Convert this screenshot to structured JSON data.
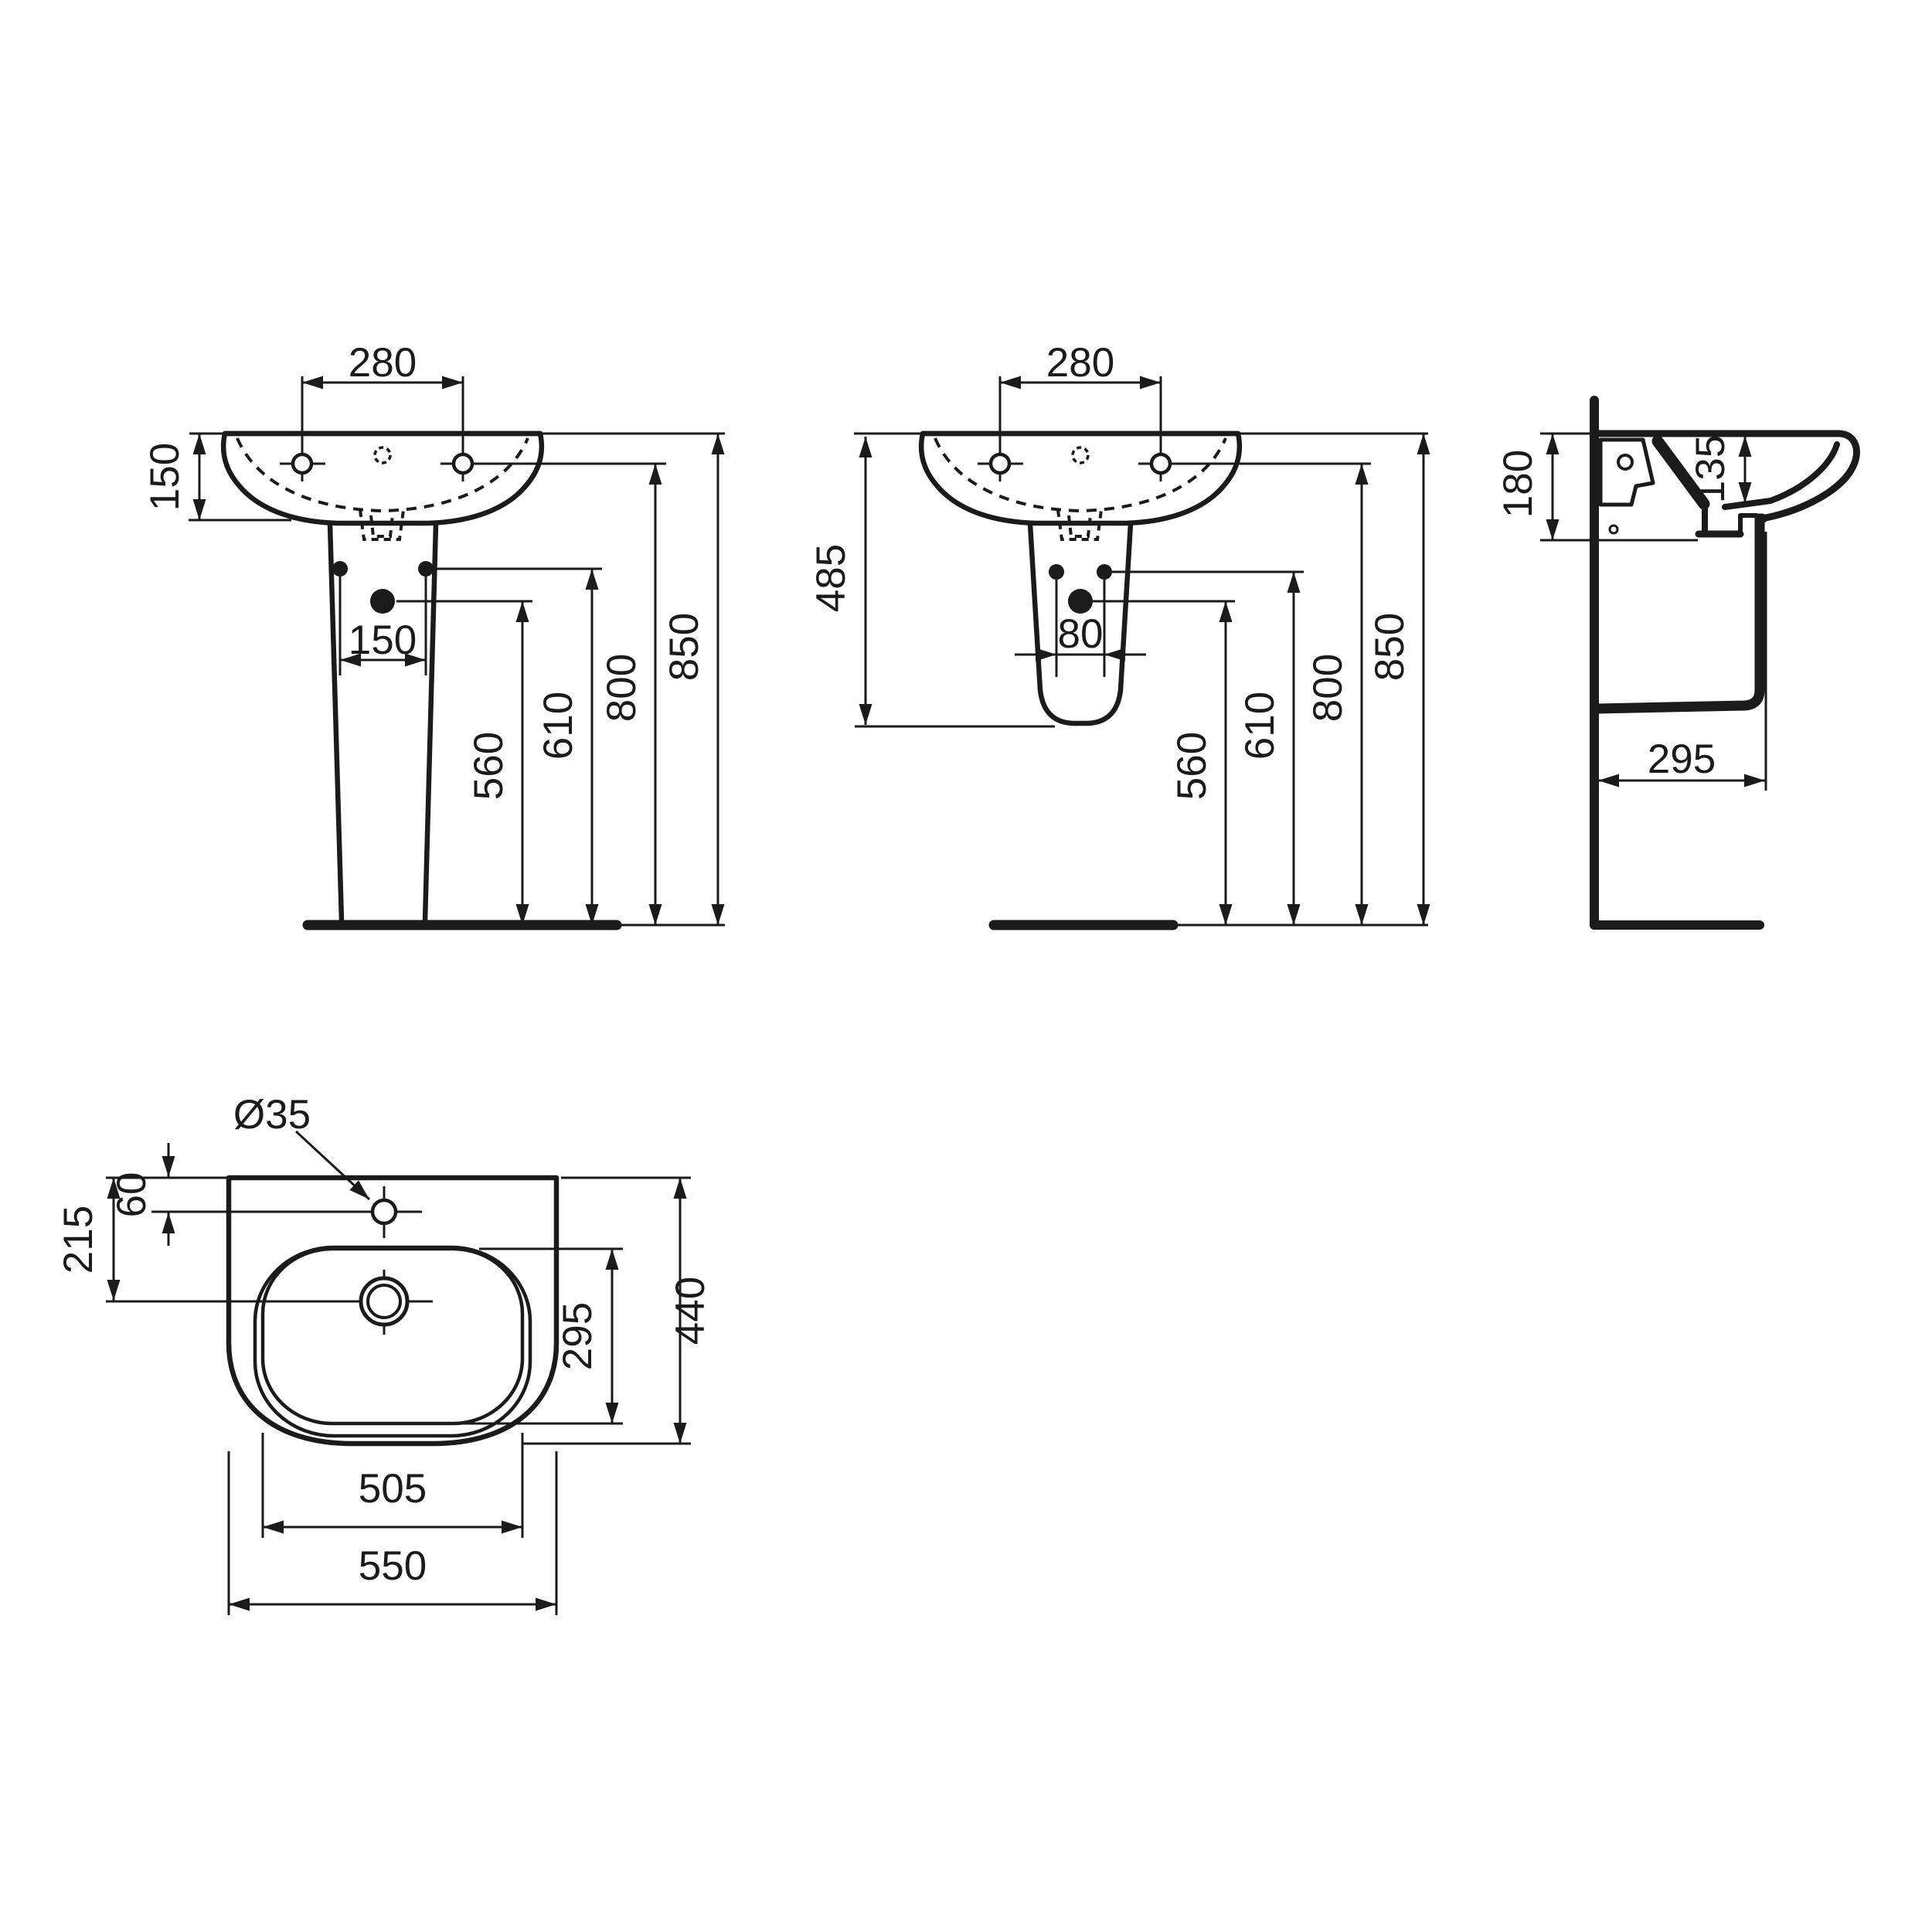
{
  "drawing": {
    "subject": "wall-hung washbasin technical dimension drawing",
    "background_color": "#ffffff",
    "line_color": "#1b1b1b",
    "views": {
      "front_full_pedestal": {
        "name": "front view with full pedestal",
        "dims": {
          "tap_hole_spacing": "280",
          "basin_rim_height": "150",
          "pedestal_hole_spacing": "150",
          "supply_height": "560",
          "fixing_hole_height": "610",
          "tap_hole_height": "800",
          "rim_height": "850"
        }
      },
      "front_semi_pedestal": {
        "name": "front view with semi-pedestal",
        "dims": {
          "tap_hole_spacing": "280",
          "semi_pedestal_height": "485",
          "pedestal_hole_spacing": "80",
          "supply_height": "560",
          "fixing_hole_height": "610",
          "tap_hole_height": "800",
          "rim_height": "850"
        }
      },
      "side": {
        "name": "side section view",
        "dims": {
          "fixing_depth": "180",
          "bowl_inner_depth": "135",
          "shroud_projection": "295"
        }
      },
      "plan": {
        "name": "plan view",
        "dims": {
          "tap_hole_diameter": "Ø35",
          "tap_hole_offset": "60",
          "drain_offset": "215",
          "bowl_depth": "295",
          "overall_depth": "440",
          "bowl_width": "505",
          "overall_width": "550"
        }
      }
    }
  }
}
